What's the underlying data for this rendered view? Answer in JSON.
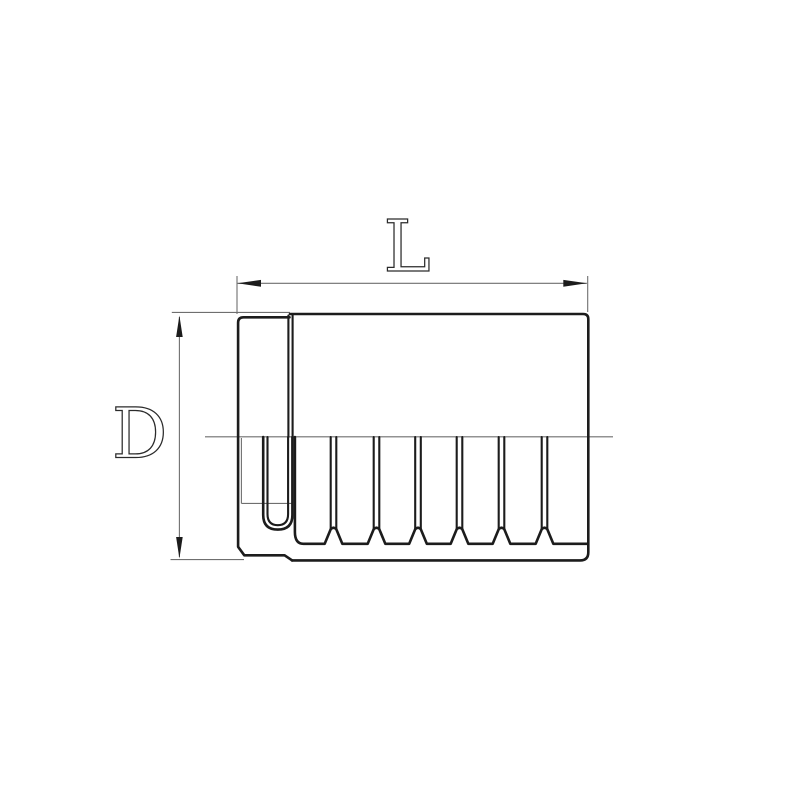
{
  "drawing": {
    "labels": {
      "length_dimension": "L",
      "diameter_dimension": "D"
    },
    "colors": {
      "background": "#ffffff",
      "outline": "#1c1c1c",
      "thin_line": "#6f6f6f",
      "letter_outline": "#2b2b2b"
    },
    "figure": {
      "subject": "ferrule-sleeve-cross-section",
      "groove_count": 6
    }
  }
}
